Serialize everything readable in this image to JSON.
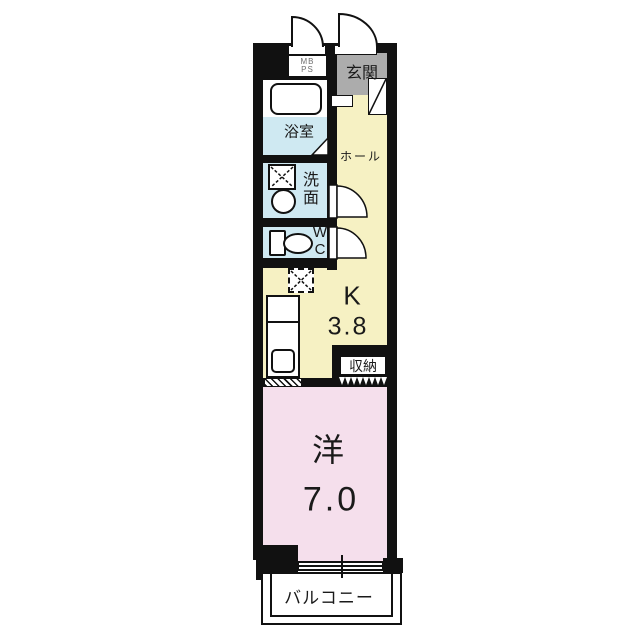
{
  "title": "apartment-floor-plan",
  "colors": {
    "wall": "#111111",
    "hall_floor": "#f6f1c3",
    "wet_floor": "#cfe9f2",
    "entry_floor": "#acacac",
    "room_floor": "#f5dfec",
    "outline_white": "#ffffff",
    "text": "#1a1a1a",
    "meter_text": "#6e6e6e"
  },
  "rooms": {
    "entrance": {
      "label": "玄関"
    },
    "meter_box": {
      "line1": "MB",
      "line2": "PS"
    },
    "bathroom": {
      "label": "浴室"
    },
    "hall": {
      "label": "ホール"
    },
    "washroom": {
      "char1": "洗",
      "char2": "面"
    },
    "wc": {
      "line1": "W",
      "line2": "C"
    },
    "kitchen": {
      "label": "K",
      "size": "3.8"
    },
    "storage": {
      "label": "収納"
    },
    "western_room": {
      "label": "洋",
      "size": "7.0"
    },
    "balcony": {
      "label": "バルコニー"
    }
  }
}
